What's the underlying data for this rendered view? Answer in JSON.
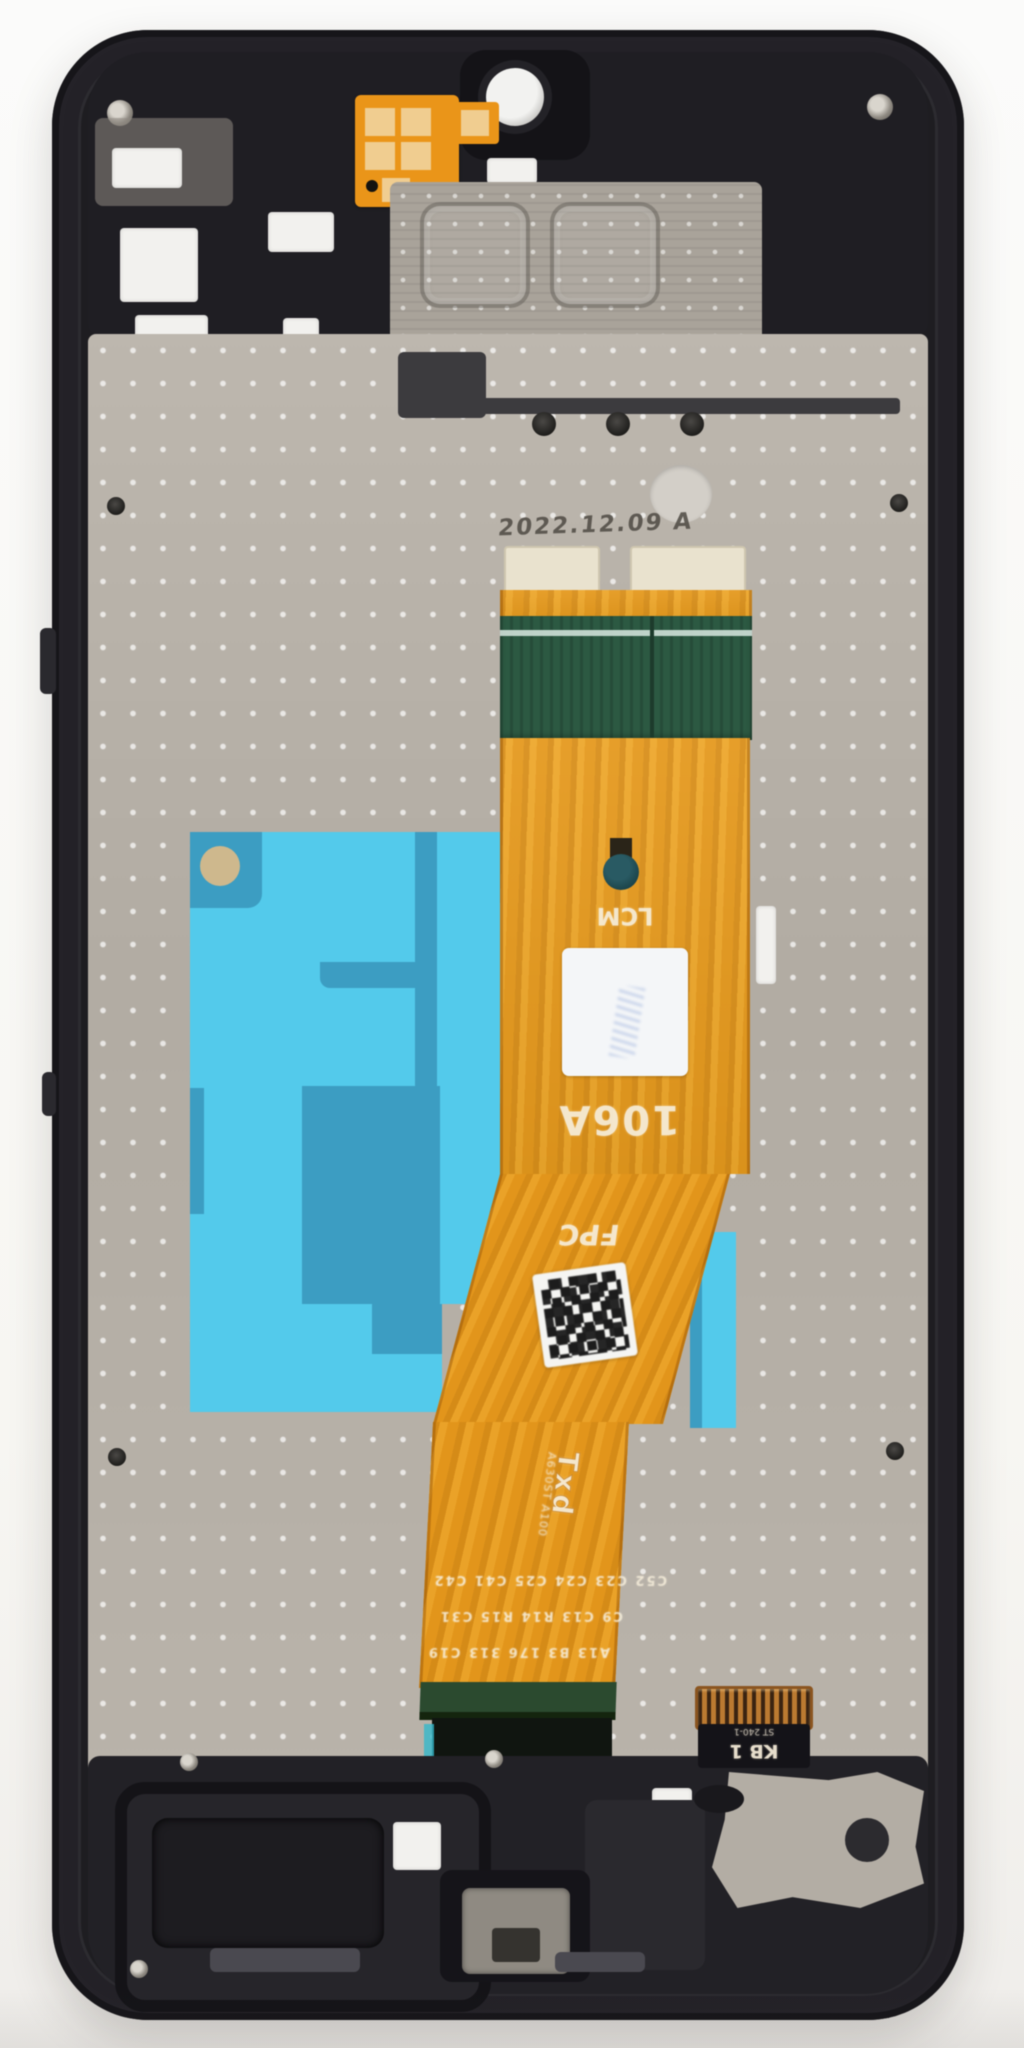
{
  "image": {
    "type": "product-photo",
    "subject": "Smartphone LCD screen assembly with middle frame, rear view, flex cable folded over back plate",
    "background_color": "#f7f6f3"
  },
  "markings": {
    "date_stamp": "2022.12.09 A",
    "lcm_label": "LCM",
    "model_label": "106A",
    "fpc_label": "FPC",
    "txd_label": "Txd",
    "vertical_marking": "A630ST A100",
    "kb_label": "KB 1",
    "kb_sublabel": "ST 240-1",
    "silkscreen_rows": [
      "C52 C23 C24 C25 C41 C42",
      "C9 C13 R14 R15 C31",
      "A13  B3  176 313  C19"
    ]
  },
  "colors": {
    "frame_black": "#232127",
    "back_plate_grey": "#b6b0a8",
    "flex_orange": "#e79e24",
    "pcb_green": "#2d5942",
    "adhesive_cyan": "#56c9e9",
    "adhesive_teal": "#3e9cc0",
    "label_white": "#f4f6f8",
    "connector_gold": "#b97a33"
  }
}
